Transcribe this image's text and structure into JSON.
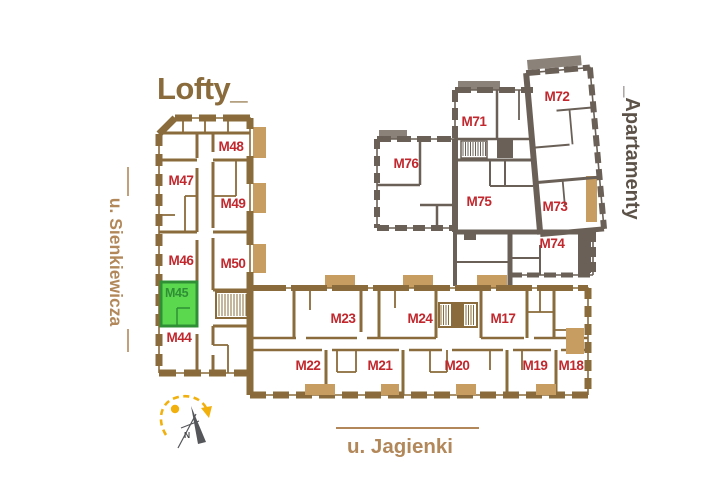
{
  "buildings": {
    "lofty": {
      "title": "Lofty_"
    },
    "apartamenty": {
      "title": "_Apartamenty"
    }
  },
  "streets": {
    "west": "u. Sienkiewicza",
    "south": "u. Jagienki"
  },
  "compass": {
    "north": "N"
  },
  "highlight": {
    "unit": "M45"
  },
  "units": {
    "m17": {
      "label": "M17"
    },
    "m18": {
      "label": "M18"
    },
    "m19": {
      "label": "M19"
    },
    "m20": {
      "label": "M20"
    },
    "m21": {
      "label": "M21"
    },
    "m22": {
      "label": "M22"
    },
    "m23": {
      "label": "M23"
    },
    "m24": {
      "label": "M24"
    },
    "m44": {
      "label": "M44"
    },
    "m45": {
      "label": "M45"
    },
    "m46": {
      "label": "M46"
    },
    "m47": {
      "label": "M47"
    },
    "m48": {
      "label": "M48"
    },
    "m49": {
      "label": "M49"
    },
    "m50": {
      "label": "M50"
    },
    "m71": {
      "label": "M71"
    },
    "m72": {
      "label": "M72"
    },
    "m73": {
      "label": "M73"
    },
    "m74": {
      "label": "M74"
    },
    "m75": {
      "label": "M75"
    },
    "m76": {
      "label": "M76"
    }
  },
  "colors": {
    "wall_brown": "#8a6b3b",
    "wall_gray": "#6a6057",
    "cap_gray": "#8b8279",
    "balcony_tan": "#c79d61",
    "unit_red": "#c1272d",
    "street_tan": "#b2885a",
    "apart_text": "#5c5248",
    "green_fill": "#5cd84f",
    "green_dark": "#2f8f35",
    "compass_yellow": "#f2b00d",
    "needle_gray": "#55565a"
  }
}
